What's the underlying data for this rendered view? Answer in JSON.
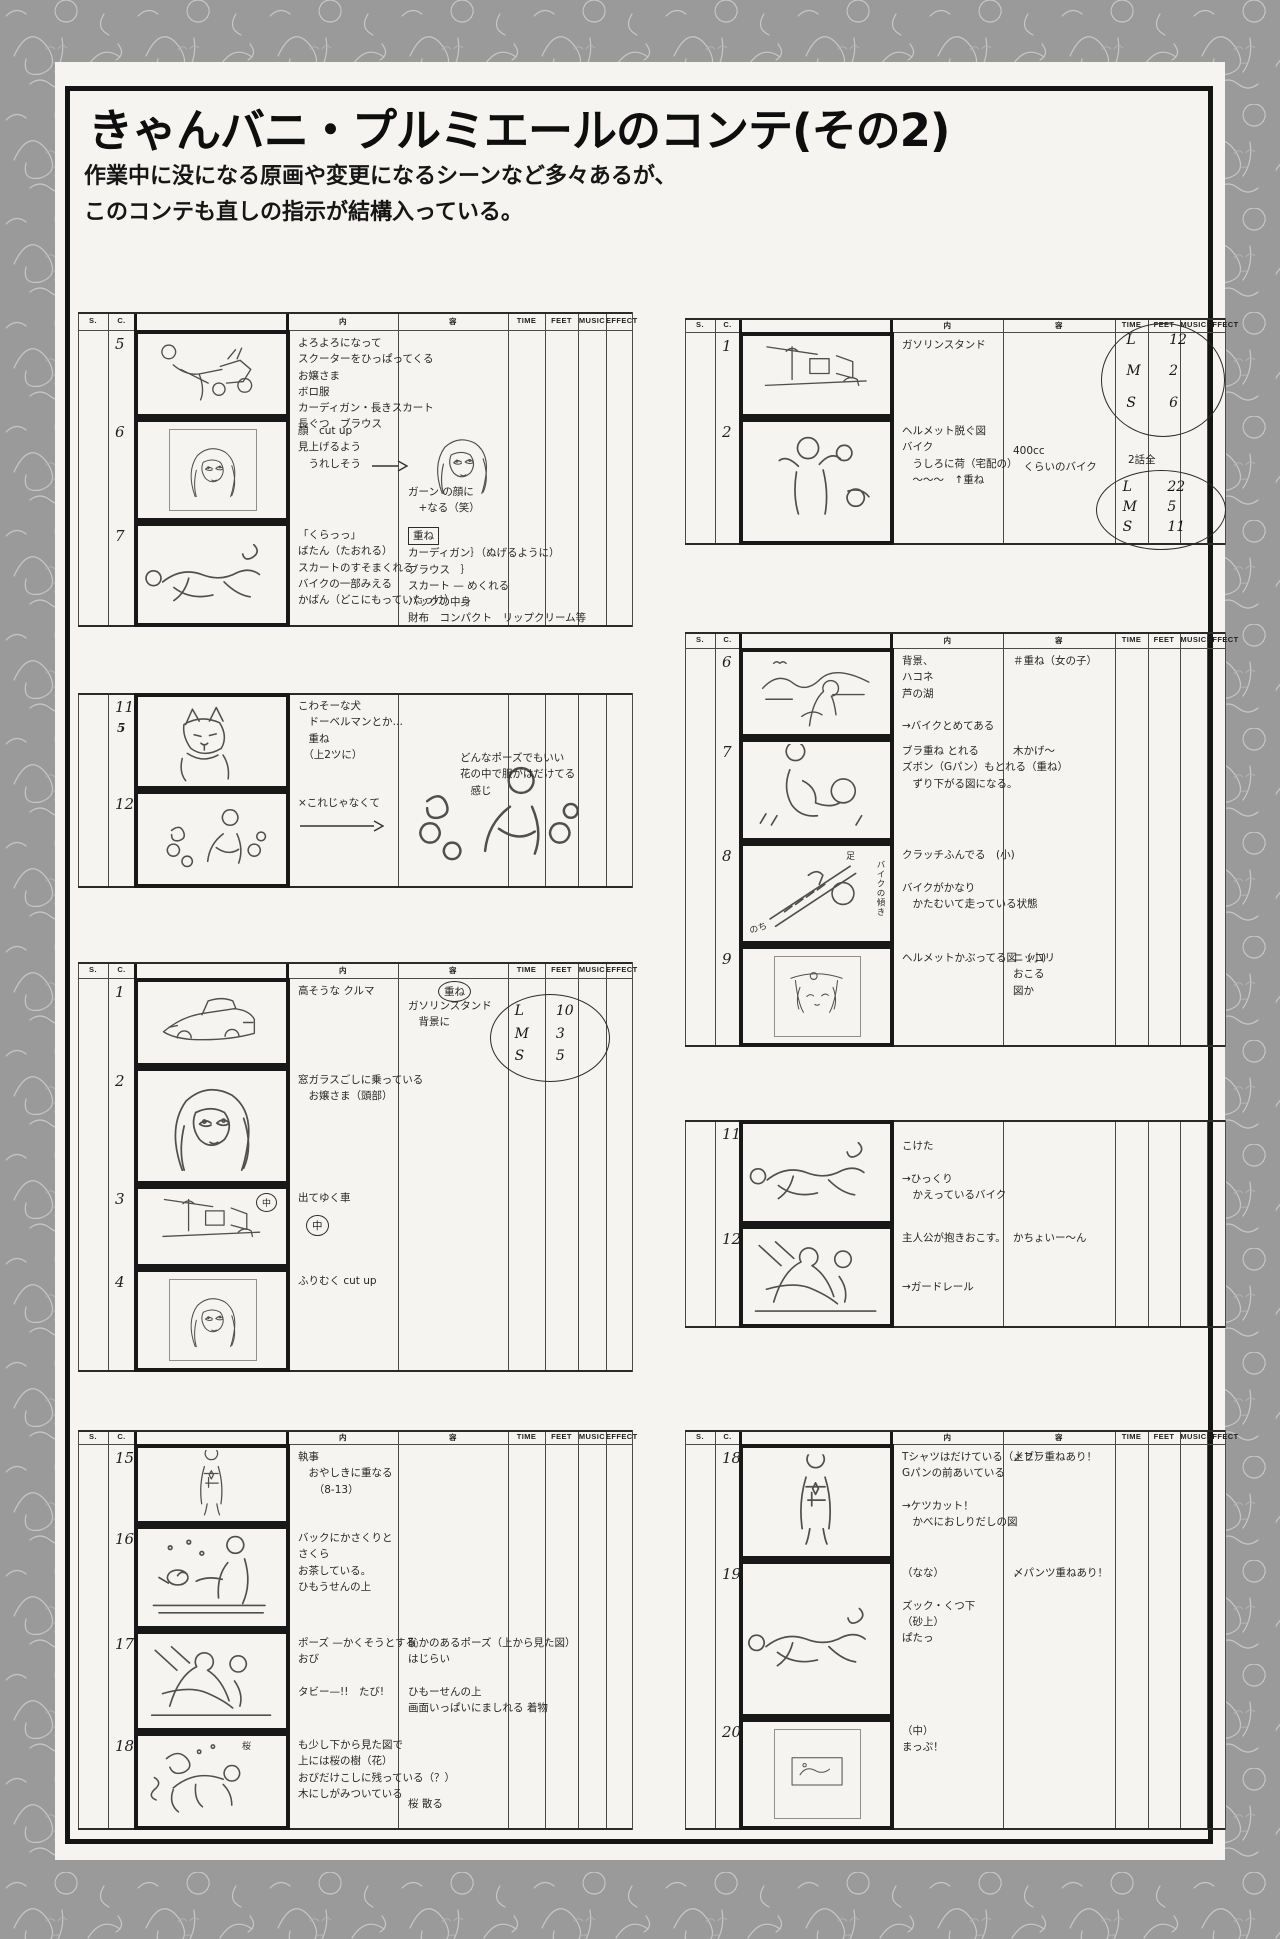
{
  "page": {
    "title": "きゃんバニ・プルミエールのコンテ(その2)",
    "subtitle_line1": "作業中に没になる原画や変更になるシーンなど多々あるが、",
    "subtitle_line2": "このコンテも直しの指示が結構入っている。"
  },
  "sheet_headers": {
    "s": "S.",
    "c": "C.",
    "content": "内",
    "dialogue": "容",
    "time": "TIME",
    "feet": "FEET",
    "music": "MUSIC",
    "effect": "EFFECT"
  },
  "sheets": [
    {
      "name": "cuts-5-7-scooter",
      "cuts": [
        {
          "no": "5",
          "sketch": "girl-pulling-scooter",
          "notes": [
            "よろよろになって",
            "スクーターをひっぱってくる",
            "お嬢さま",
            "ボロ服",
            "カーディガン・長きスカート",
            "長ぐつ　ブラウス"
          ],
          "notes2": []
        },
        {
          "no": "6",
          "sketch": "girl-face-closeup",
          "inner": true,
          "notes": [
            "顔　cut up",
            "見上げるよう",
            "　うれしそう"
          ],
          "notes2": [
            "ガーン の顔に",
            "　+なる（笑）"
          ]
        },
        {
          "no": "7",
          "sketch": "girl-fallen",
          "notes": [
            "「くらっっ」",
            "ばたん（たおれる）",
            "スカートのすそまくれる",
            "バイクの一部みえる",
            "かばん（どこにもっていたっけ）"
          ],
          "notes2": [
            "重ね",
            "カーディガン｝（ぬげるように）",
            "ブラウス　｝",
            "スカート — めくれる",
            "バックの中身",
            "財布　コンパクト　リップクリーム等"
          ],
          "notes2_boxed_first": true
        }
      ]
    },
    {
      "name": "cuts-11-12-dog",
      "revision": {
        "lines": [
          "どんなポーズでもいい",
          "花の中で服がはだけてる",
          "　感じ"
        ]
      },
      "cuts": [
        {
          "no": "11",
          "sub": "5",
          "sketch": "doberman-dog",
          "notes": [
            "こわそーな犬",
            "　ドーベルマンとか…",
            "　重ね",
            "　（上2ツに）"
          ],
          "notes2": []
        },
        {
          "no": "12",
          "sketch": "girl-in-roses",
          "notes": [
            "×これじゃなくて"
          ],
          "notes2": []
        }
      ]
    },
    {
      "name": "cuts-1-4-car",
      "overlay_label": "重ね",
      "lms1": {
        "rows": [
          [
            "L",
            "10"
          ],
          [
            "M",
            "3"
          ],
          [
            "S",
            "5"
          ]
        ]
      },
      "cuts": [
        {
          "no": "1",
          "sketch": "expensive-car",
          "notes": [
            "高そうな クルマ"
          ],
          "notes2": [
            "ガソリンスタンド",
            "　背景に"
          ]
        },
        {
          "no": "2",
          "sketch": "girl-in-car-window",
          "notes": [
            "窓ガラスごしに乗っている",
            "　お嬢さま（頭部）"
          ],
          "notes2": []
        },
        {
          "no": "3",
          "sketch": "car-leaving-street",
          "circled": "中",
          "pic_circled": "中",
          "notes": [
            "出てゆく車"
          ],
          "notes2": []
        },
        {
          "no": "4",
          "sketch": "girl-looking-back",
          "inner": true,
          "notes": [
            "ふりむく cut up"
          ],
          "notes2": []
        }
      ]
    },
    {
      "name": "cuts-15-18-sakura",
      "cuts": [
        {
          "no": "15",
          "sketch": "butler-standing",
          "notes": [
            "執事",
            "　おやしきに重なる",
            "　　（8-13）"
          ],
          "notes2": []
        },
        {
          "no": "16",
          "sketch": "tea-on-red-carpet",
          "notes": [
            "バックにかさくりと",
            "さくら",
            "お茶している。",
            "ひもうせんの上"
          ],
          "notes2": []
        },
        {
          "no": "17",
          "sketch": "girls-lying-on-carpet",
          "notes": [
            "ポーズ —かくそうとする",
            "おび",
            "",
            "タビー—!!　たび!"
          ],
          "notes2": [
            "恥かのあるポーズ（上から見た図）",
            "はじらい",
            "",
            "ひもーせんの上",
            "画面いっぱいにましれる 着物"
          ]
        },
        {
          "no": "18",
          "sketch": "girl-clinging-to-tree",
          "pic_labels": [
            "桜"
          ],
          "notes": [
            "も少し下から見た図で",
            "上には桜の樹（花）",
            "おびだけこしに残っている（？）",
            "木にしがみついている"
          ],
          "notes2": [
            "桜 散る"
          ]
        }
      ]
    },
    {
      "name": "cuts-1-2-gas-station",
      "episode_total_label": "2話全",
      "lms1": {
        "rows": [
          [
            "L",
            "12"
          ],
          [
            "M",
            "2"
          ],
          [
            "S",
            "6"
          ]
        ]
      },
      "lms2": {
        "rows": [
          [
            "L",
            "22"
          ],
          [
            "M",
            "5"
          ],
          [
            "S",
            "11"
          ]
        ]
      },
      "cuts": [
        {
          "no": "1",
          "sketch": "gas-station-street",
          "notes": [
            "ガソリンスタンド"
          ],
          "notes2": []
        },
        {
          "no": "2",
          "sketch": "rider-removing-helmet",
          "notes": [
            "ヘルメット脱ぐ図",
            "バイク",
            "　うしろに荷（宅配の）",
            "　〜〜〜　↑重ね"
          ],
          "notes2": [
            "400cc",
            "　くらいのバイク"
          ]
        }
      ]
    },
    {
      "name": "cuts-6-9-hakone",
      "cuts": [
        {
          "no": "6",
          "sketch": "hakone-lake-girl",
          "notes": [
            "背景、",
            "ハコネ",
            "芦の湖",
            "",
            "→バイクとめてある"
          ],
          "notes2": [
            "＃重ね（女の子）"
          ]
        },
        {
          "no": "7",
          "sketch": "girl-riding-away",
          "notes": [
            "ブラ重ね とれる",
            "ズボン（Gパン）もとれる（重ね）",
            "　ずり下がる図になる。"
          ],
          "notes2": [
            "木かげ〜"
          ]
        },
        {
          "no": "8",
          "sketch": "leaning-bike-foot-on-clutch",
          "pic_labels": [
            "足",
            "バイクの傾き",
            "のち"
          ],
          "notes": [
            "クラッチふんでる　(小)",
            "",
            "バイクがかなり",
            "　かたむいて走っている状態"
          ],
          "notes2": []
        },
        {
          "no": "9",
          "sketch": "face-in-helmet",
          "inner": true,
          "notes": [
            "ヘルメットかぶってる図　(小)"
          ],
          "notes2": [
            "ニッコリ",
            "おこる",
            "図か"
          ]
        }
      ]
    },
    {
      "name": "cuts-11-12-crash",
      "cuts": [
        {
          "no": "11",
          "sketch": "girl-fallen-with-bike",
          "notes": [
            "こけた",
            "",
            "→ひっくり",
            "　かえっているバイク"
          ],
          "notes2": []
        },
        {
          "no": "12",
          "sketch": "hero-lifting-girl",
          "notes": [
            "主人公が抱きおこす。",
            "",
            "",
            "→ガードレール"
          ],
          "notes2": [
            "かちょいー〜ん"
          ]
        }
      ]
    },
    {
      "name": "cuts-18-20",
      "cuts": [
        {
          "no": "18",
          "sketch": "girl-shirt-open-standing",
          "notes": [
            "Tシャツはだけている（上ヒ）",
            "Gパンの前あいている",
            "",
            "→ケツカット！",
            "　かべにおしりだしの図"
          ],
          "notes2": [
            "〆ブラ重ねあり！"
          ]
        },
        {
          "no": "19",
          "sketch": "girl-collapsed-on-sand",
          "notes": [
            "（なな）",
            "",
            "ズック・くつ下",
            "（砂上）",
            "ぱたっ"
          ],
          "notes2": [
            "〆パンツ重ねあり！"
          ]
        },
        {
          "no": "20",
          "sketch": "map-sketch",
          "inner": true,
          "notes": [
            "（中）",
            "まっぷ！"
          ],
          "notes2": []
        }
      ]
    }
  ]
}
